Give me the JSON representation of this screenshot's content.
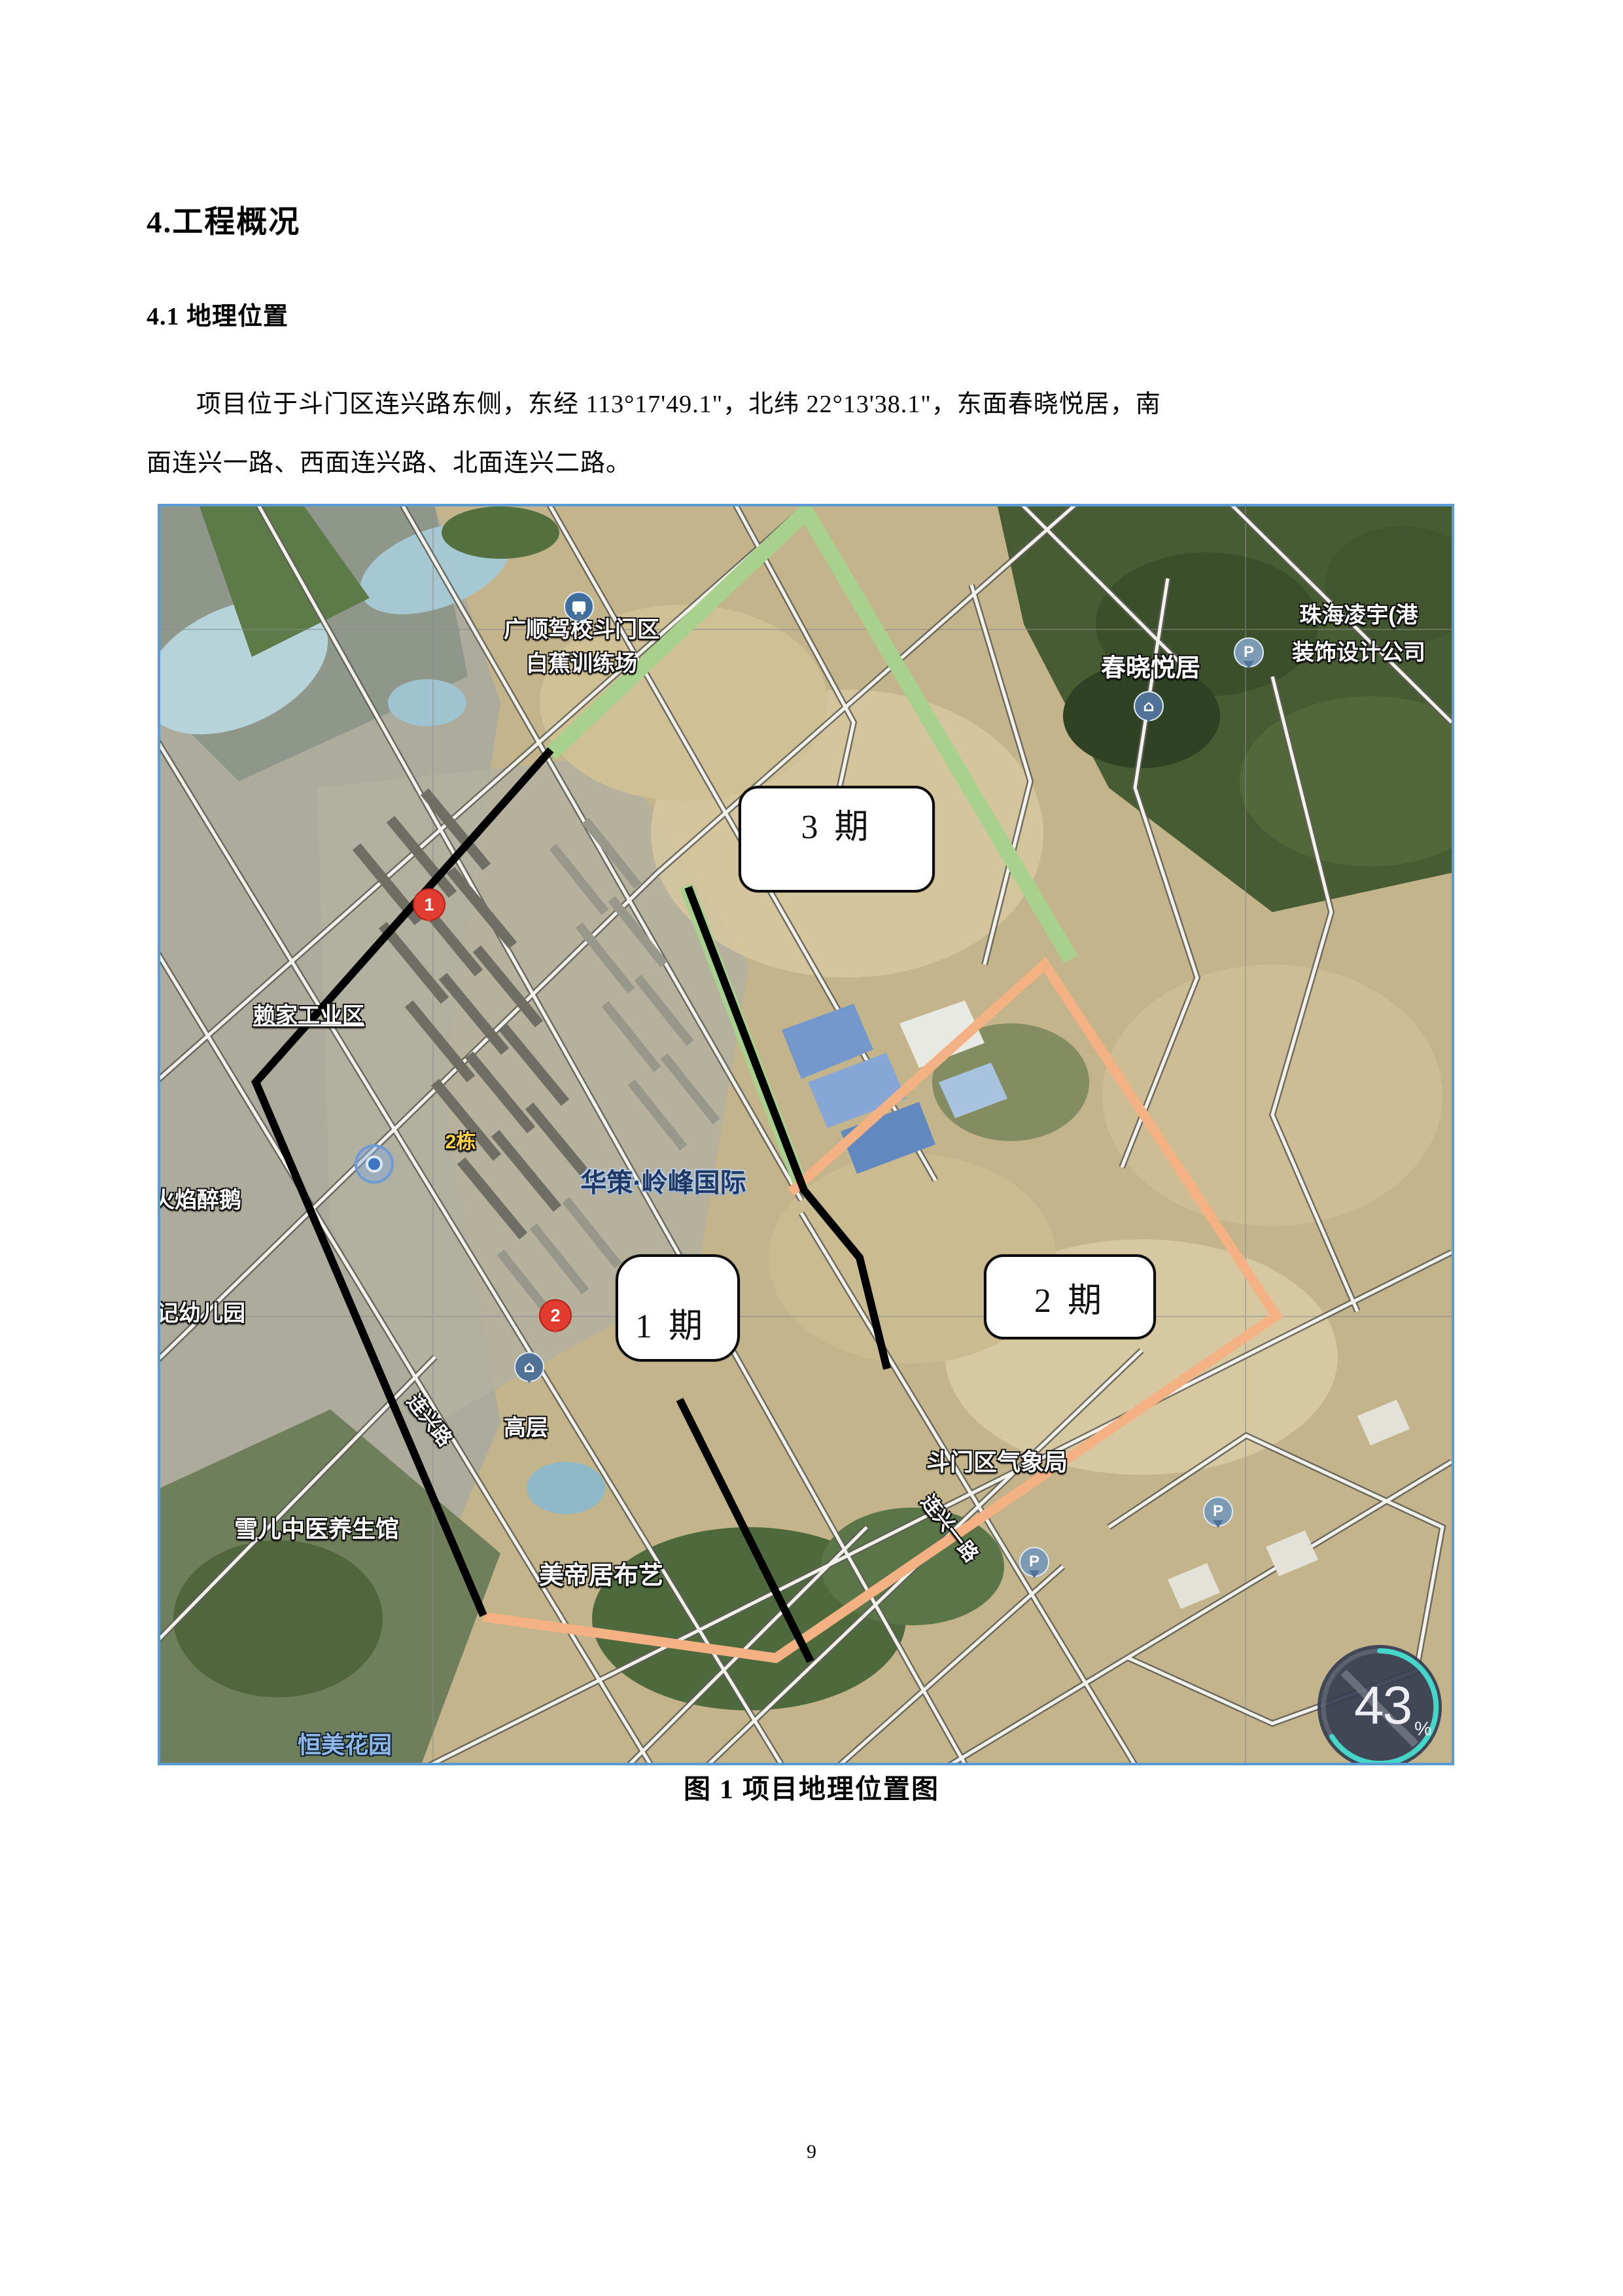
{
  "doc": {
    "heading1": "4.工程概况",
    "heading2": "4.1 地理位置",
    "paragraph_line1": "项目位于斗门区连兴路东侧，东经 113°17'49.1\"，北纬 22°13'38.1\"，东面春晓悦居，南",
    "paragraph_line2": "面连兴一路、西面连兴路、北面连兴二路。",
    "figure_caption": "图 1  项目地理位置图",
    "page_number": "9"
  },
  "map": {
    "border_color": "#5b9bd5",
    "phase_colors": {
      "phase1": "#000000",
      "phase2": "#f4b183",
      "phase3": "#a9d18e"
    },
    "phases": {
      "p1": {
        "label": "1 期"
      },
      "p2": {
        "label": "2 期"
      },
      "p3": {
        "label": "3 期"
      }
    },
    "labels": {
      "driving_school_l1": "广顺驾校斗门区",
      "driving_school_l2": "白蕉训练场",
      "chunxiao": "春晓悦居",
      "zhuhai_l1": "珠海凌宇(港",
      "zhuhai_l2": "装饰设计公司",
      "laijia": "赖家工业区",
      "huoyan": "火焰醉鹅",
      "dong2": "2栋",
      "huace": "华策·岭峰国际",
      "kindergarten": "记幼儿园",
      "gaoceng": "高层",
      "lianxing_road": "连兴路",
      "xueer": "雪儿中医养生馆",
      "meidiju": "美帝居布艺",
      "weather_bureau": "斗门区气象局",
      "lianxing_yilu": "连兴一路",
      "hengmei": "恒美花园"
    },
    "pins": {
      "pin1": "1",
      "pin2": "2",
      "parking": "P"
    },
    "compass": {
      "value": "43",
      "unit": "%"
    }
  }
}
